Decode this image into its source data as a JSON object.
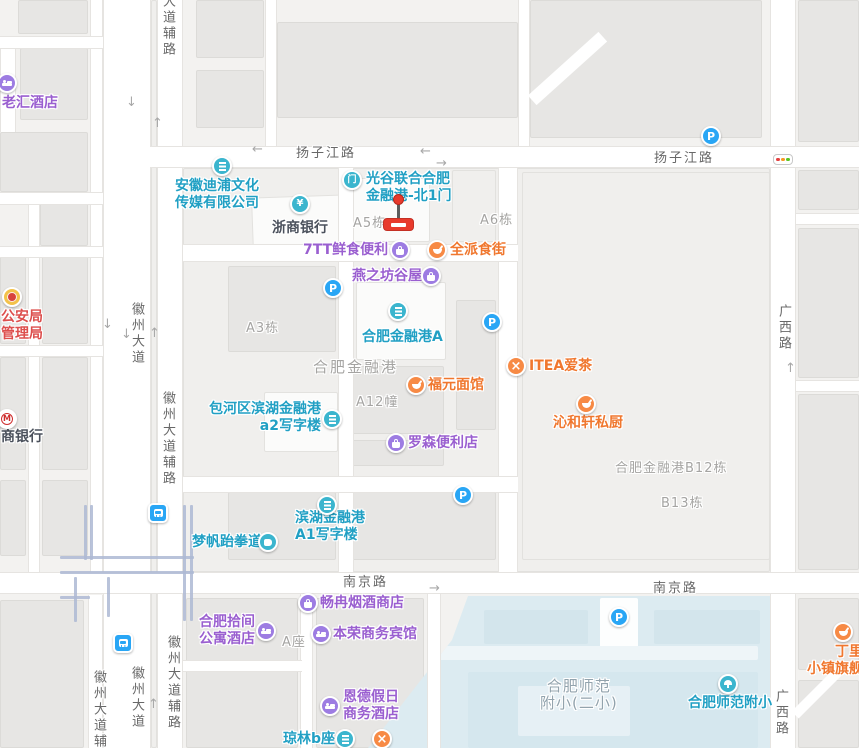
{
  "colors": {
    "teal": "#21a0c4",
    "tealIcon": "#3bb5ce",
    "purple": "#9a5fd0",
    "purpleIcon": "#9d7ce2",
    "orange": "#f0772e",
    "orangeIcon": "#f78a45",
    "dark": "#4b515c",
    "red": "#dd4f4d",
    "govIcon": "#f3c24a",
    "blue": "#29a6f5",
    "grayLabel": "#a5a4a2",
    "roadLabel": "#686868",
    "schoolLabel": "#92a3ad",
    "markerRed": "#e83a2c",
    "water": "#dcebf1"
  },
  "traffic_light": {
    "x": 782,
    "y": 159,
    "dots": [
      "#e34040",
      "#f59a23",
      "#58c322"
    ]
  },
  "marker": {
    "x": 398,
    "ball_y": 199,
    "stem_top": 204,
    "base_top": 218
  },
  "pois": [
    {
      "id": "laohui-hotel",
      "cat": "purple",
      "icon": "bed",
      "ix": 7,
      "iy": 83,
      "left": 2,
      "top": 95,
      "lines": [
        "老汇酒店"
      ]
    },
    {
      "id": "anhui-dipu-media",
      "cat": "teal",
      "icon": "bldg",
      "ix": 222,
      "iy": 166,
      "left": 175,
      "top": 178,
      "lines": [
        "安徽迪浦文化",
        "传媒有限公司"
      ]
    },
    {
      "id": "zheshang-bank",
      "cat": "dark",
      "icon": "yen",
      "ix": 300,
      "iy": 204,
      "left": 272,
      "top": 220,
      "lines": [
        "浙商银行"
      ]
    },
    {
      "id": "guanggu-north-gate-1",
      "cat": "teal",
      "icon": "door",
      "ix": 352,
      "iy": 180,
      "left": 366,
      "top": 171,
      "lines": [
        "光谷联合合肥",
        "金融港-北1门"
      ]
    },
    {
      "id": "7tt-fresh-convenience",
      "cat": "purple",
      "icon": "bag",
      "ix": 400,
      "iy": 250,
      "left": 303,
      "top": 242,
      "lines": [
        "7TT鲜食便利"
      ]
    },
    {
      "id": "quanpai-food-street",
      "cat": "orange",
      "icon": "bowl",
      "ix": 437,
      "iy": 250,
      "left": 450,
      "top": 242,
      "lines": [
        "全派食街"
      ]
    },
    {
      "id": "yanzhifang-guwu",
      "cat": "purple",
      "icon": "bag",
      "ix": 431,
      "iy": 276,
      "left": 352,
      "top": 268,
      "lines": [
        "燕之坊谷屋"
      ]
    },
    {
      "id": "hefei-financial-port-a",
      "cat": "teal",
      "icon": "bldg",
      "ix": 398,
      "iy": 311,
      "left": 362,
      "top": 329,
      "lines": [
        "合肥金融港A"
      ]
    },
    {
      "id": "fuyuan-noodles",
      "cat": "orange",
      "icon": "bowl",
      "ix": 416,
      "iy": 385,
      "left": 428,
      "top": 377,
      "lines": [
        "福元面馆"
      ]
    },
    {
      "id": "itea-tea",
      "cat": "orange",
      "icon": "xfork",
      "ix": 516,
      "iy": 366,
      "left": 529,
      "top": 358,
      "lines": [
        "ITEA爱茶"
      ]
    },
    {
      "id": "qinhexuan-kitchen",
      "cat": "orange",
      "icon": "bowl",
      "ix": 586,
      "iy": 404,
      "left": 553,
      "top": 415,
      "lines": [
        "沁和轩私厨"
      ]
    },
    {
      "id": "baohe-binhu-a2-tower",
      "cat": "teal",
      "icon": "bldg",
      "ix": 332,
      "iy": 419,
      "right": 538,
      "top": 401,
      "lines": [
        "包河区滨湖金融港",
        "a2写字楼"
      ]
    },
    {
      "id": "lawson-convenience",
      "cat": "purple",
      "icon": "bag",
      "ix": 396,
      "iy": 443,
      "left": 408,
      "top": 435,
      "lines": [
        "罗森便利店"
      ]
    },
    {
      "id": "binhu-a1-tower",
      "cat": "teal",
      "icon": "bldg",
      "ix": 327,
      "iy": 505,
      "left": 295,
      "top": 510,
      "lines": [
        "滨湖金融港",
        "A1写字楼"
      ]
    },
    {
      "id": "mengfan-taekwondo",
      "cat": "teal",
      "icon": "fist",
      "ix": 268,
      "iy": 542,
      "left": 192,
      "top": 534,
      "lines": [
        "梦帆跆拳道"
      ]
    },
    {
      "id": "changran-tobacco-wine",
      "cat": "purple",
      "icon": "bag",
      "ix": 308,
      "iy": 603,
      "left": 320,
      "top": 595,
      "lines": [
        "畅冉烟酒商店"
      ]
    },
    {
      "id": "hefei-shijian-apartment-hotel",
      "cat": "purple",
      "icon": "bed",
      "ix": 266,
      "iy": 631,
      "right": 604,
      "top": 614,
      "lines": [
        "合肥拾间",
        "公寓酒店"
      ]
    },
    {
      "id": "benrong-business-hotel",
      "cat": "purple",
      "icon": "bed",
      "ix": 321,
      "iy": 634,
      "left": 333,
      "top": 626,
      "lines": [
        "本荣商务宾馆"
      ]
    },
    {
      "id": "ende-holiday-hotel",
      "cat": "purple",
      "icon": "bed",
      "ix": 330,
      "iy": 706,
      "left": 343,
      "top": 689,
      "lines": [
        "恩德假日",
        "商务酒店"
      ]
    },
    {
      "id": "qionglin-b-block",
      "cat": "teal",
      "icon": "bldg",
      "ix": 345,
      "iy": 739,
      "left": 283,
      "top": 731,
      "lines": [
        "琼林b座"
      ]
    },
    {
      "id": "restaurant-unnamed",
      "cat": "orange",
      "icon": "xfork",
      "ix": 382,
      "iy": 739,
      "lines": []
    },
    {
      "id": "hefei-shifan-primary",
      "cat": "teal",
      "icon": "tree",
      "ix": 728,
      "iy": 684,
      "left": 688,
      "top": 695,
      "lines": [
        "合肥师范附小"
      ]
    },
    {
      "id": "dingliyang-flagship",
      "cat": "orange",
      "icon": "bowl",
      "ix": 843,
      "iy": 632,
      "right": -18,
      "top": 644,
      "lines": [
        "丁里羊",
        "小镇旗舰店"
      ]
    },
    {
      "id": "public-security-bureau",
      "cat": "red",
      "icon": "gov",
      "ix": 12,
      "iy": 297,
      "left": 1,
      "top": 309,
      "lines": [
        "公安局",
        "管理局"
      ]
    },
    {
      "id": "cmb-bank",
      "cat": "dark",
      "icon": "cmb",
      "ix": 7,
      "iy": 419,
      "left": 1,
      "top": 429,
      "lines": [
        "商银行"
      ]
    }
  ],
  "area_labels": [
    {
      "text": "A5栋",
      "left": 353,
      "top": 215
    },
    {
      "text": "A6栋",
      "left": 480,
      "top": 212
    },
    {
      "text": "A3栋",
      "left": 246,
      "top": 320
    },
    {
      "text": "A12幢",
      "left": 356,
      "top": 394
    },
    {
      "text": "A座",
      "left": 282,
      "top": 634
    },
    {
      "text": "合肥金融港",
      "left": 313,
      "top": 359,
      "cls": "big"
    },
    {
      "text": "合肥金融港B12栋",
      "left": 615,
      "top": 460
    },
    {
      "text": "B13栋",
      "left": 661,
      "top": 495
    },
    {
      "lines": [
        "合肥师范",
        "附小(二小)"
      ],
      "left": 540,
      "top": 678,
      "cls": "school-lbl"
    }
  ],
  "road_labels": [
    {
      "text": "扬子江路",
      "left": 296,
      "top": 145
    },
    {
      "text": "扬子江路",
      "left": 654,
      "top": 150
    },
    {
      "text": "南京路",
      "left": 343,
      "top": 574
    },
    {
      "text": "南京路",
      "left": 653,
      "top": 580
    },
    {
      "text": "广西路",
      "left": 775,
      "top": 304,
      "v": true
    },
    {
      "text": "广西路",
      "left": 772,
      "top": 689,
      "v": true
    },
    {
      "text": "大道辅路",
      "left": 159,
      "top": -6,
      "v": true
    },
    {
      "text": "徽州大道",
      "left": 128,
      "top": 302,
      "v": true
    },
    {
      "text": "徽州大道辅路",
      "left": 159,
      "top": 391,
      "v": true
    },
    {
      "text": "徽州大道",
      "left": 128,
      "top": 666,
      "v": true
    },
    {
      "text": "徽州大道辅路",
      "left": 164,
      "top": 635,
      "v": true
    },
    {
      "text": "徽州大道辅路",
      "left": 90,
      "top": 670,
      "v": true
    }
  ],
  "parking_icons": [
    [
      711,
      136
    ],
    [
      333,
      288
    ],
    [
      492,
      322
    ],
    [
      463,
      495
    ],
    [
      619,
      617
    ]
  ],
  "metro_icons": [
    [
      158,
      513
    ],
    [
      123,
      643
    ]
  ],
  "arrows": [
    [
      126,
      96,
      "↓"
    ],
    [
      152,
      117,
      "↑"
    ],
    [
      252,
      143,
      "←"
    ],
    [
      420,
      145,
      "←"
    ],
    [
      436,
      157,
      "→"
    ],
    [
      102,
      318,
      "↓"
    ],
    [
      121,
      328,
      "↓"
    ],
    [
      149,
      327,
      "↑"
    ],
    [
      429,
      582,
      "→"
    ],
    [
      148,
      698,
      "↑"
    ],
    [
      785,
      362,
      "↑"
    ]
  ]
}
